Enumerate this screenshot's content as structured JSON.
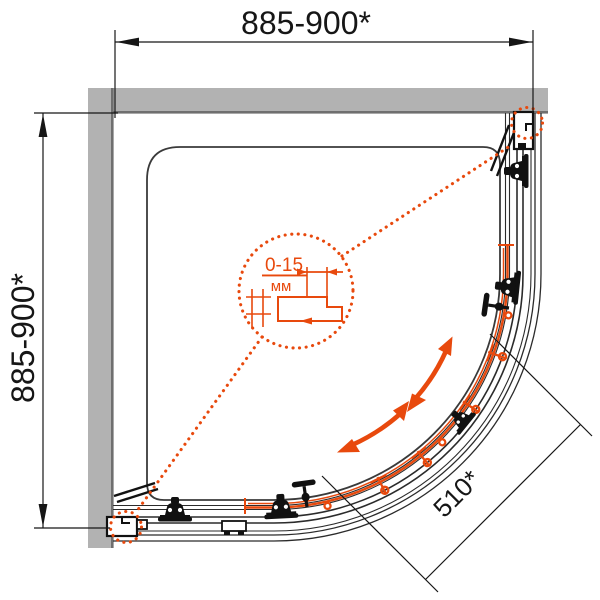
{
  "drawing": {
    "type": "shower-enclosure-quarter-round-plan",
    "dimensions": {
      "top": {
        "label": "885-900*"
      },
      "left": {
        "label": "885-900*"
      },
      "diagonal": {
        "label": "510*"
      }
    },
    "detail_callout": {
      "range": "0-15",
      "unit": "мм"
    },
    "colors": {
      "accent_orange": "#e8490d",
      "wall_fill": "#b2b2b2",
      "wall_edge": "#6f6f6f",
      "drawing_line": "#2b2b2b",
      "text_ink": "#161616"
    }
  }
}
